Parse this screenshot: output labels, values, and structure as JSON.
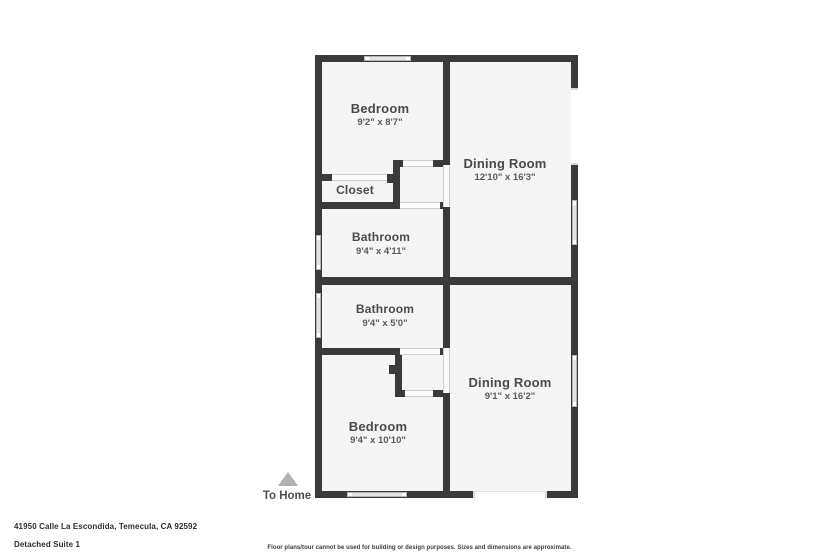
{
  "colors": {
    "wall": "#3a3a3a",
    "floor": "#f5f5f5",
    "window": "#e4e4e4",
    "label_text": "#4a4a4a",
    "entry_marker": "#b0b0b0"
  },
  "floorplan": {
    "rooms": [
      {
        "name": "Bedroom",
        "dims": "9'2\" x 8'7\""
      },
      {
        "name": "Dining Room",
        "dims": "12'10\" x 16'3\""
      },
      {
        "name": "Closet",
        "dims": ""
      },
      {
        "name": "Bathroom",
        "dims": "9'4\" x 4'11\""
      },
      {
        "name": "Bathroom",
        "dims": "9'4\" x 5'0\""
      },
      {
        "name": "Dining Room",
        "dims": "9'1\" x 16'2\""
      },
      {
        "name": "Bedroom",
        "dims": "9'4\" x 10'10\""
      }
    ],
    "entry_label": "To Home"
  },
  "footer": {
    "address": "41950 Calle La Escondida, Temecula, CA 92592",
    "unit": "Detached Suite 1",
    "disclaimer": "Floor plans/tour cannot be used for building or design purposes. Sizes and dimensions are approximate."
  }
}
